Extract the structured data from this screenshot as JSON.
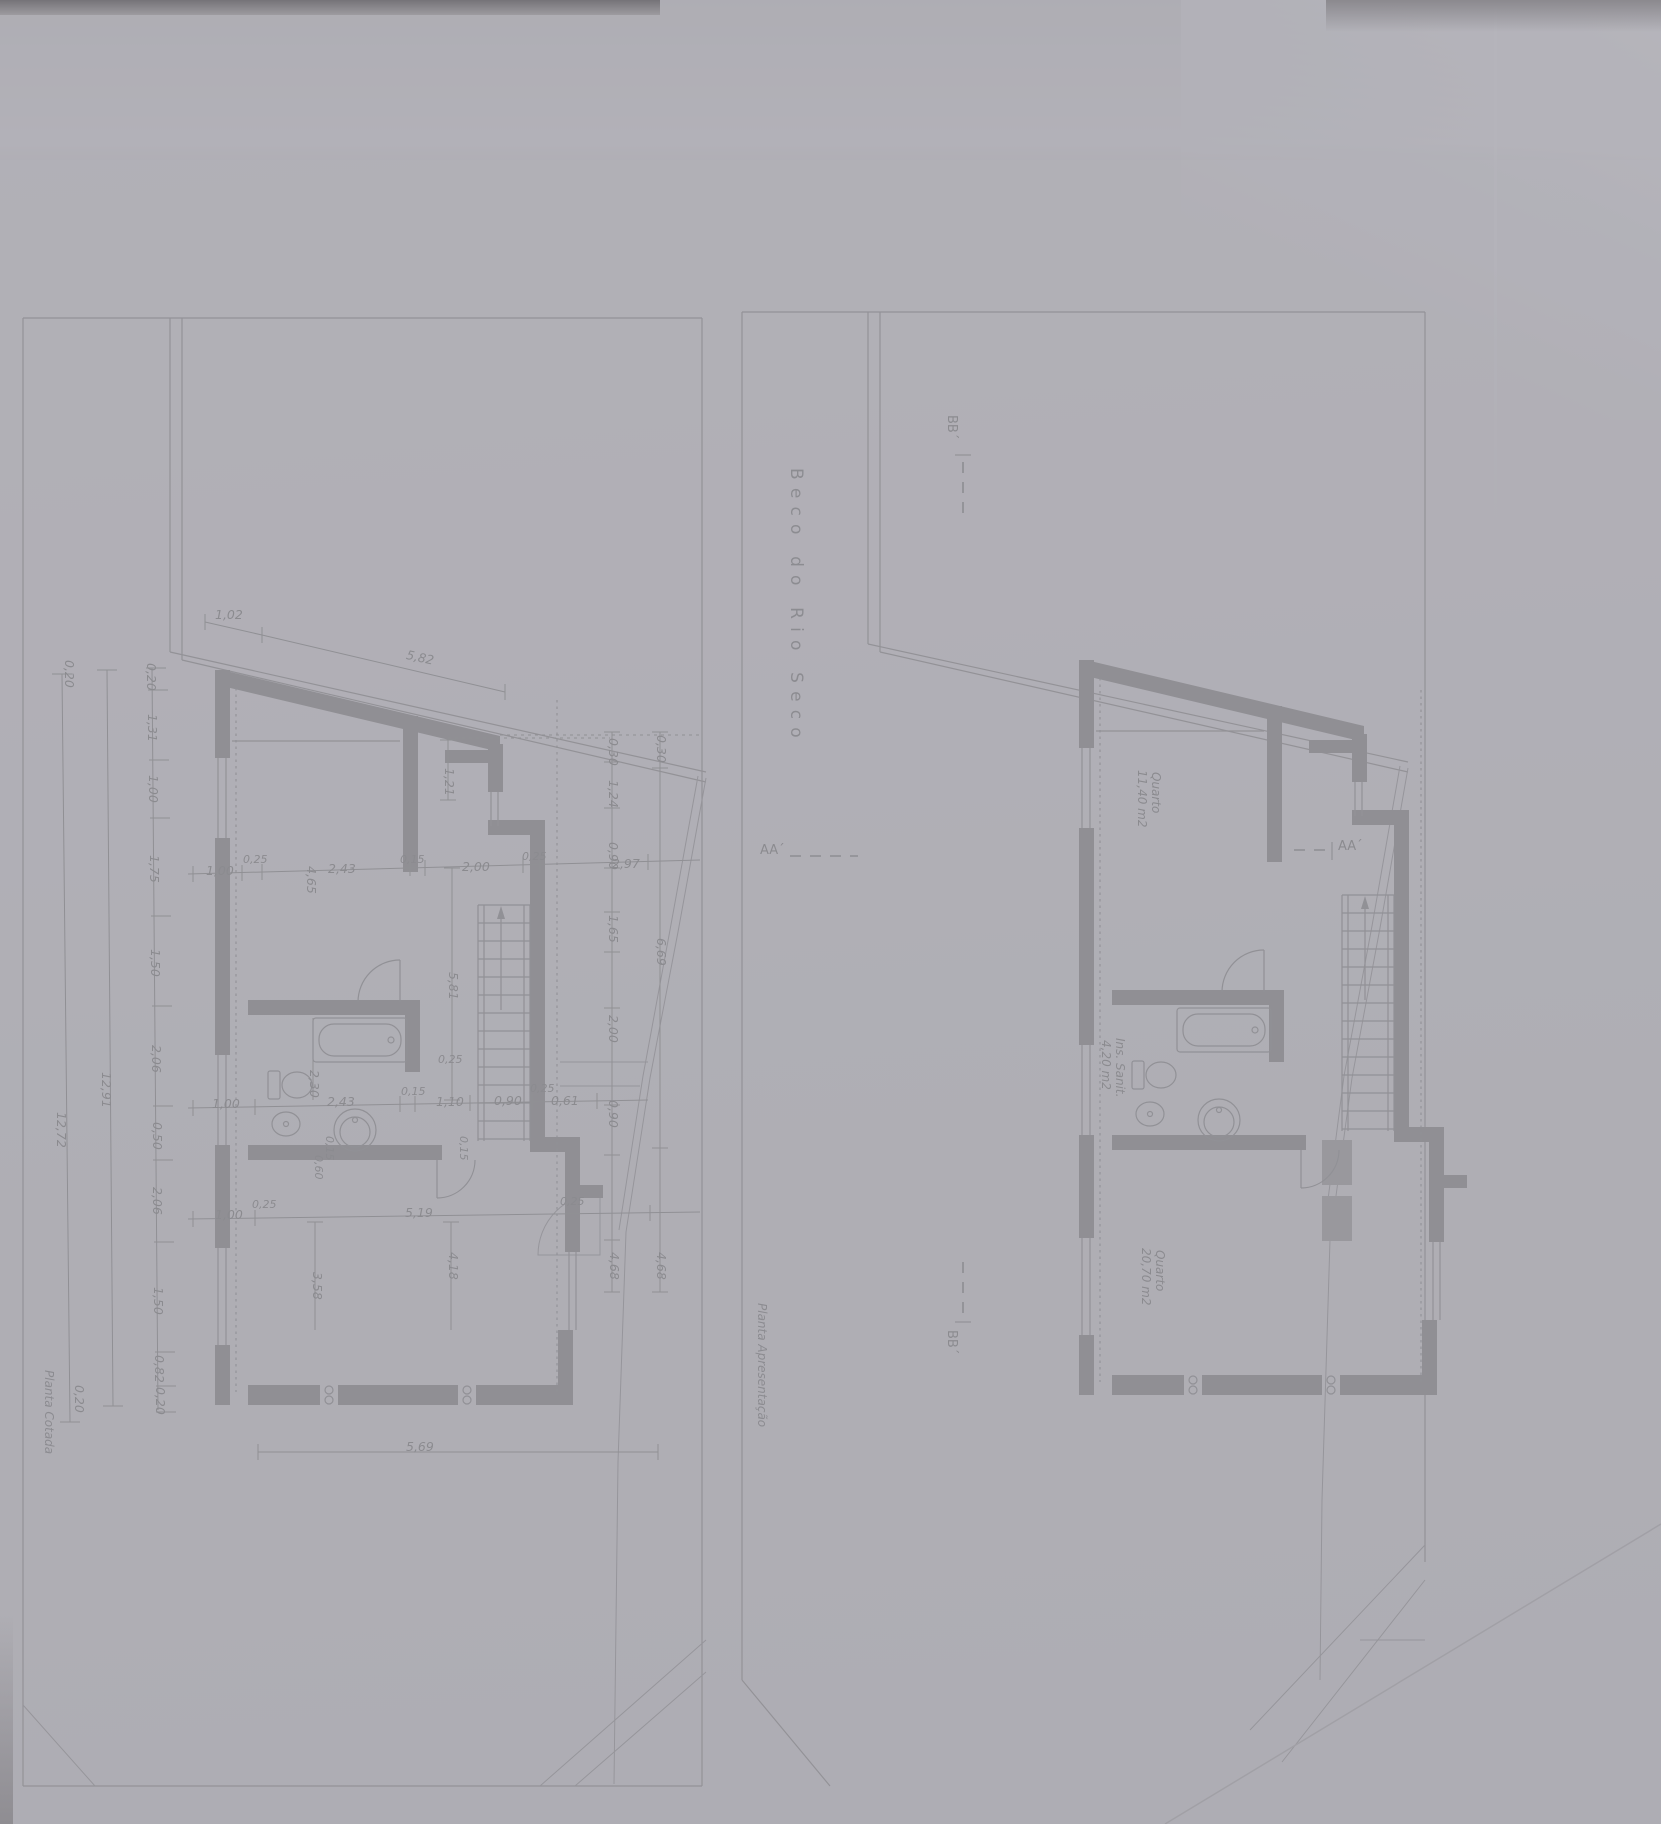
{
  "titles": {
    "street": "Beco do Rio Seco"
  },
  "captions": {
    "left_plan": "Planta Cotada",
    "right_plan": "Planta Apresentação"
  },
  "sections": {
    "aa": "AA´",
    "bb": "BB´"
  },
  "rooms": {
    "quarto1_name": "Quarto",
    "quarto1_area": "11,40 m2",
    "sanit_name": "Ins. Sanit.",
    "sanit_area": "4,20 m2",
    "quarto2_name": "Quarto",
    "quarto2_area": "20,70 m2"
  },
  "dims": {
    "top_offset": "1,02",
    "top_wall": "5,82",
    "chain": [
      "0,20",
      "1,31",
      "1,00",
      "1,75",
      "1,50",
      "2,06",
      "0,50",
      "2,06",
      "1,50",
      "0,82",
      "0,20"
    ],
    "total_inner": "12,91",
    "total_outer": "12,72",
    "total_end_top": "0,20",
    "total_end_bottom": "0,20",
    "row_upper": [
      "1,00",
      "0,25",
      "4,65",
      "2,43",
      "0,15",
      "2,00",
      "0,25",
      "2,97"
    ],
    "col_right_inner": [
      "0,30",
      "1,24",
      "0,90",
      "1,65",
      "2,00",
      "0,90",
      "4,68"
    ],
    "col_right_outer": [
      "0,30",
      "6,69",
      "4,68"
    ],
    "col_mid": [
      "1,21",
      "5,81",
      "2,30",
      "0,60",
      "0,15",
      "0,15"
    ],
    "row_lower": [
      "1,00",
      "2,43",
      "0,15",
      "1,10",
      "0,90",
      "0,61"
    ],
    "row_bottom": [
      "1,00",
      "0,25",
      "5,19"
    ],
    "col_bottom": [
      "3,58",
      "4,18"
    ],
    "bottom_wall": "5,69",
    "wall_ticks": [
      "0,25",
      "0,25",
      "0,25"
    ]
  },
  "colors": {
    "paper": "#d8d7db",
    "shadow": "#c4c3c8",
    "wall": "#4d4c53",
    "line": "#54535a",
    "text": "#3b3a41"
  }
}
